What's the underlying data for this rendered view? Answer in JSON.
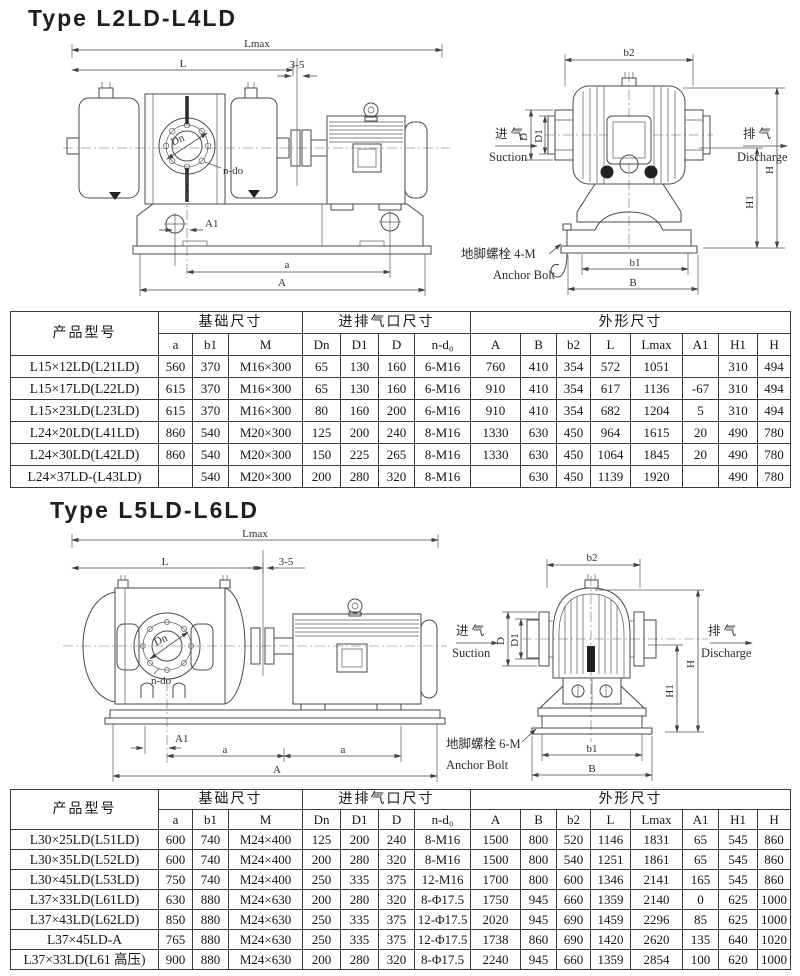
{
  "section1": {
    "title": "Type L2LD-L4LD",
    "side_view": {
      "lmax": "Lmax",
      "l": "L",
      "gap": "3-5",
      "dn": "Dn",
      "n_do": "n-do",
      "a1": "A1",
      "a": "a",
      "a_total": "A"
    },
    "end_view": {
      "b2": "b2",
      "d": "D",
      "d1": "D1",
      "h": "H",
      "h1": "H1",
      "b1": "b1",
      "b": "B",
      "suction_cn": "进 气",
      "suction_en": "Suction",
      "discharge_cn": "排 气",
      "discharge_en": "Discharge",
      "anchor_cn": "地脚螺栓 4-M",
      "anchor_en": "Anchor Bolt"
    },
    "rows": [
      [
        "L15×12LD(L21LD)",
        "560",
        "370",
        "M16×300",
        "65",
        "130",
        "160",
        "6-M16",
        "760",
        "410",
        "354",
        "572",
        "1051",
        "",
        "310",
        "494"
      ],
      [
        "L15×17LD(L22LD)",
        "615",
        "370",
        "M16×300",
        "65",
        "130",
        "160",
        "6-M16",
        "910",
        "410",
        "354",
        "617",
        "1136",
        "-67",
        "310",
        "494"
      ],
      [
        "L15×23LD(L23LD)",
        "615",
        "370",
        "M16×300",
        "80",
        "160",
        "200",
        "6-M16",
        "910",
        "410",
        "354",
        "682",
        "1204",
        "5",
        "310",
        "494"
      ],
      [
        "L24×20LD(L41LD)",
        "860",
        "540",
        "M20×300",
        "125",
        "200",
        "240",
        "8-M16",
        "1330",
        "630",
        "450",
        "964",
        "1615",
        "20",
        "490",
        "780"
      ],
      [
        "L24×30LD(L42LD)",
        "860",
        "540",
        "M20×300",
        "150",
        "225",
        "265",
        "8-M16",
        "1330",
        "630",
        "450",
        "1064",
        "1845",
        "20",
        "490",
        "780"
      ],
      [
        "L24×37LD-(L43LD)",
        "",
        "540",
        "M20×300",
        "200",
        "280",
        "320",
        "8-M16",
        "",
        "630",
        "450",
        "1139",
        "1920",
        "",
        "490",
        "780"
      ]
    ]
  },
  "section2": {
    "title": "Type L5LD-L6LD",
    "side_view": {
      "lmax": "Lmax",
      "l": "L",
      "gap": "3-5",
      "dn": "Dn",
      "n_do": "n-do",
      "a1": "A1",
      "a_left": "a",
      "a_right": "a",
      "a_total": "A"
    },
    "end_view": {
      "b2": "b2",
      "d": "D",
      "d1": "D1",
      "h": "H",
      "h1": "H1",
      "b1": "b1",
      "b": "B",
      "suction_cn": "进 气",
      "suction_en": "Suction",
      "discharge_cn": "排 气",
      "discharge_en": "Discharge",
      "anchor_cn": "地脚螺栓 6-M",
      "anchor_en": "Anchor Bolt"
    },
    "rows": [
      [
        "L30×25LD(L51LD)",
        "600",
        "740",
        "M24×400",
        "125",
        "200",
        "240",
        "8-M16",
        "1500",
        "800",
        "520",
        "1146",
        "1831",
        "65",
        "545",
        "860"
      ],
      [
        "L30×35LD(L52LD)",
        "600",
        "740",
        "M24×400",
        "200",
        "280",
        "320",
        "8-M16",
        "1500",
        "800",
        "540",
        "1251",
        "1861",
        "65",
        "545",
        "860"
      ],
      [
        "L30×45LD(L53LD)",
        "750",
        "740",
        "M24×400",
        "250",
        "335",
        "375",
        "12-M16",
        "1700",
        "800",
        "600",
        "1346",
        "2141",
        "165",
        "545",
        "860"
      ],
      [
        "L37×33LD(L61LD)",
        "630",
        "880",
        "M24×630",
        "200",
        "280",
        "320",
        "8-Φ17.5",
        "1750",
        "945",
        "660",
        "1359",
        "2140",
        "0",
        "625",
        "1000"
      ],
      [
        "L37×43LD(L62LD)",
        "850",
        "880",
        "M24×630",
        "250",
        "335",
        "375",
        "12-Φ17.5",
        "2020",
        "945",
        "690",
        "1459",
        "2296",
        "85",
        "625",
        "1000"
      ],
      [
        "L37×45LD-A",
        "765",
        "880",
        "M24×630",
        "250",
        "335",
        "375",
        "12-Φ17.5",
        "1738",
        "860",
        "690",
        "1420",
        "2620",
        "135",
        "640",
        "1020"
      ],
      [
        "L37×33LD(L61 高压)",
        "900",
        "880",
        "M24×630",
        "200",
        "280",
        "320",
        "8-Φ17.5",
        "2240",
        "945",
        "660",
        "1359",
        "2854",
        "100",
        "620",
        "1000"
      ]
    ]
  },
  "table_headers": {
    "model": "产品型号",
    "base_group": "基础尺寸",
    "port_group": "进排气口尺寸",
    "outline_group": "外形尺寸",
    "cols": [
      "a",
      "b1",
      "M",
      "Dn",
      "D1",
      "D",
      "n-d₀",
      "A",
      "B",
      "b2",
      "L",
      "Lmax",
      "A1",
      "H1",
      "H"
    ]
  }
}
